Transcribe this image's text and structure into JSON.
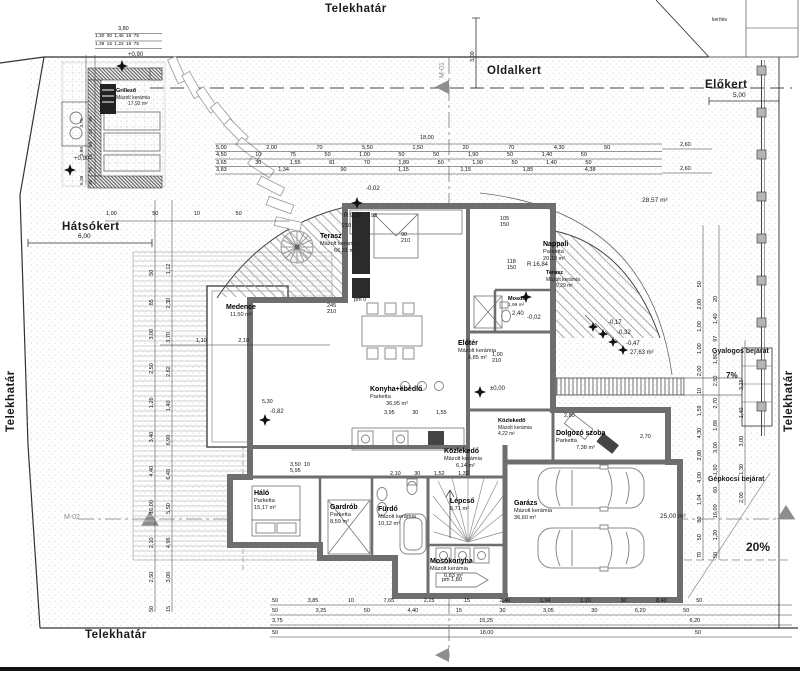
{
  "boundary": {
    "top": "Telekhatár",
    "bottom": "Telekhatár",
    "left": "Telekhatár",
    "right": "Telekhatár",
    "fence_note": "kerítés"
  },
  "gardens": {
    "back": "Hátsókert",
    "back_dim": "6,00",
    "side": "Oldalkert",
    "side_dim": "3,00",
    "front": "Előkert",
    "front_dim": "5,00"
  },
  "sections": {
    "m01": "M-01",
    "m02": "M-02"
  },
  "rooms": [
    {
      "name": "Grillező",
      "finish": "Mázolt kerámia",
      "area": "17,92 m²"
    },
    {
      "name": "Terasz",
      "finish": "Mázolt kerámia",
      "area": "66,31 m²"
    },
    {
      "name": "Nappali",
      "finish": "Parketta",
      "area": "20,10 m²"
    },
    {
      "name": "Terasz",
      "finish": "Mázolt kerámia",
      "area": "9,29 m²"
    },
    {
      "name": "Konyha+ébédlő",
      "finish": "Parketta",
      "area": "36,95 m²"
    },
    {
      "name": "Előtér",
      "finish": "Mázolt kerámia",
      "area": "6,85 m²"
    },
    {
      "name": "Mosdó",
      "finish": "Mázolt kerámia",
      "area": "1,98 m²"
    },
    {
      "name": "Háló",
      "finish": "Parketta",
      "area": "15,17 m²"
    },
    {
      "name": "Gardrób",
      "finish": "Parketta",
      "area": "8,59 m²"
    },
    {
      "name": "Fürdő",
      "finish": "Mázolt kerámia",
      "area": "10,12 m²"
    },
    {
      "name": "Lépcső",
      "finish": "",
      "area": "6,71 m²"
    },
    {
      "name": "Mosókonyha",
      "finish": "Mázolt kerámia",
      "area": "6,83 m²"
    },
    {
      "name": "Közlekedő",
      "finish": "Mázolt kerámia",
      "area": "6,14 m²"
    },
    {
      "name": "Közlekedő",
      "finish": "Mázolt kerámia",
      "area": "4,22 m²"
    },
    {
      "name": "Dolgozó szoba",
      "finish": "Parketta",
      "area": "7,38 m²"
    },
    {
      "name": "Garázs",
      "finish": "Mázolt kerámia",
      "area": "36,60 m²"
    },
    {
      "name": "Medence",
      "finish": "",
      "area": "11,50 m²"
    }
  ],
  "site": {
    "ped": "Gyalogos bejárat",
    "ped_slope": "7%",
    "car": "Gépkocsi bejárat",
    "car_slope": "20%",
    "drive_area": "25,00 m²",
    "court_area": "27,63 m²",
    "side_area": "28,57 m²"
  },
  "levels": {
    "grill_a": "+0,90",
    "grill_b": "+0,90",
    "entry": "±0,00",
    "deck": "-0,82",
    "top_step": "-0,02",
    "s1": "-0,02",
    "s2": "-0,17",
    "s3": "-0,32",
    "s4": "-0,47",
    "lintel": "2,40"
  },
  "radii": {
    "r1": "R 9,55",
    "r2": "R 16,84"
  },
  "dims": {
    "top1": "18,00",
    "top2": "5,00 2,00 70 5,50 1,50 20 70 4,30 50",
    "top3": "4,50 10 75 50 1,00 50 50 1,90 50 1,40 50",
    "top4": "3,65 30 1,55 81 70 1,89 50 1,90 50 1,40 50",
    "top5": "3,83 1,34 90 1,15 1,15 1,85 4,38",
    "top_r1": "2,60",
    "top_r2": "2,60",
    "bottom1": "50 3,85 10 7,65 2,15 15 2,40 1,94 1,20 30 8,40 50",
    "bottom2": "50 3,25 50 4,40 15 30 3,05 30 6,20 50",
    "bottom3": "3,75 15,25 6,20",
    "bottom4": "50 18,00 50",
    "left1": "50 2,50 2,10 16,00 4,40 3,40 1,26 2,50 3,00 85 50",
    "left2": "15 3,00 4,96 5,50 6,40 6,90 1,40 2,62 3,70 2,30 1,12",
    "right1": "70 50 80 1,04 4,00 3,80 4,30 1,59 10 2,00 1,00 1,00 2,00 50",
    "right2": "50 1,20 16,00 60 1,50 3,00 1,89 2,70 2,50 1,80 97 1,40 20",
    "right3": "2,00 1,30 3,00 1,40 3,25",
    "grill_t1": "3,80",
    "grill_t2": "1,30 30 1,45 15 75",
    "grill_t3": "1,38 15 1,22 15 75",
    "grill_l1": "5,39 3,80 3,75",
    "grill_l2": "30 75 15 84 15 65",
    "back_row": "1,00 50 10 50",
    "pool_row": "1,10 2,10",
    "halo_rows": "3,50  10\n5,95",
    "kitchen_row": "3,95 30 1,55",
    "bath_row": "2,10 30 1,52 1,32",
    "study_w": "2,80",
    "study_h": "2,70",
    "apron": "2,20",
    "deck_w": "5,30"
  },
  "tags": {
    "terr_door": "245\n210",
    "win1": "105\n150",
    "win2": "118\n150",
    "win3": "90\n210",
    "door1": "1,00\n210",
    "pm": "pm 1,80",
    "pm0": "pm 0",
    "k93": "93",
    "k210": "210"
  }
}
